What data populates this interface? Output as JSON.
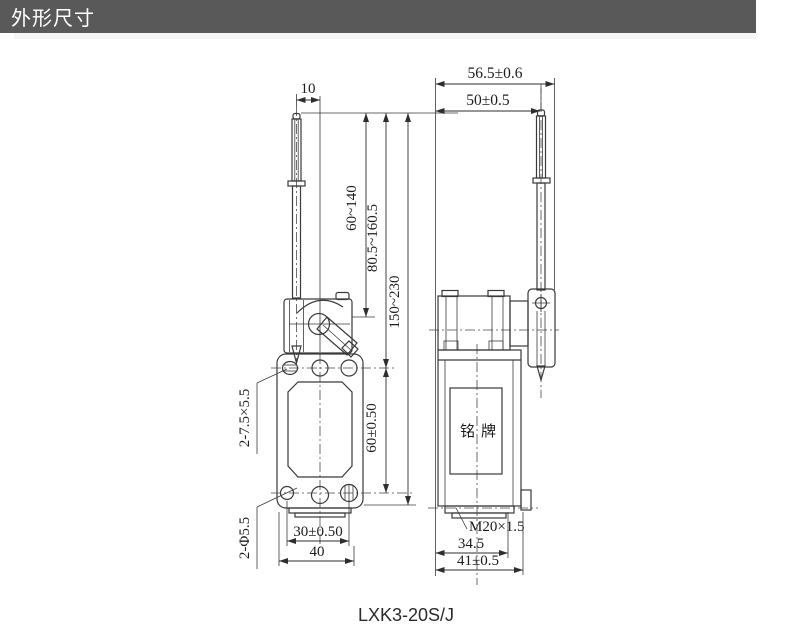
{
  "header": {
    "title": "外形尺寸"
  },
  "footer": {
    "model": "LXK3-20S/J"
  },
  "left_view": {
    "dims": {
      "lever_offset": "10",
      "travel_range_1": "60~140",
      "travel_range_2": "80.5~160.5",
      "travel_range_3": "150~230",
      "slot_spec": "2-7.5×5.5",
      "mount_hole_v_spacing": "60±0.50",
      "mount_hole_h_spacing": "30±0.50",
      "body_width": "40",
      "hole_spec": "2-Φ5.5"
    }
  },
  "right_view": {
    "dims": {
      "overall_width": "56.5±0.6",
      "rod_offset": "50±0.5",
      "thread_spec": "M20×1.5",
      "base_width": "34.5",
      "base_overall_width": "41±0.5"
    },
    "nameplate_label": "铭牌"
  }
}
